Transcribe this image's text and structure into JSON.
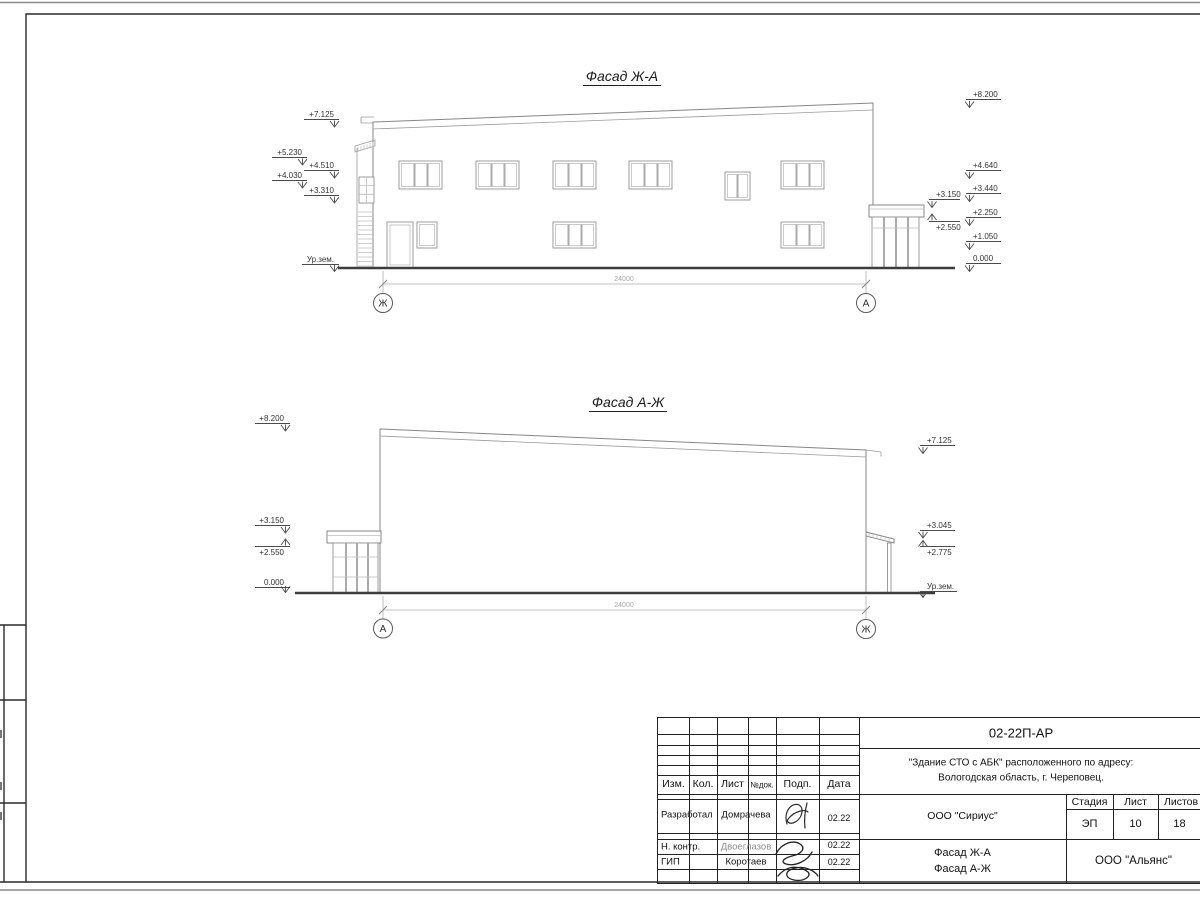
{
  "sheet": {
    "facade_top": {
      "title": "Фасад Ж-А",
      "axis_left": "Ж",
      "axis_right": "А",
      "dimension": "24000",
      "marks_left": [
        "+7.125",
        "+5.230",
        "+4.510",
        "+4.030",
        "+3.310",
        "Ур.зем."
      ],
      "marks_right": [
        "+8.200",
        "+4.640",
        "+3.440",
        "+2.250",
        "+1.050",
        "0.000"
      ],
      "marks_porch": [
        "+3.150",
        "+2.550"
      ]
    },
    "facade_bottom": {
      "title": "Фасад А-Ж",
      "axis_left": "А",
      "axis_right": "Ж",
      "dimension": "24000",
      "marks_left": [
        "+8.200",
        "+3.150",
        "+2.550",
        "0.000"
      ],
      "marks_right": [
        "+7.125",
        "+3.045",
        "+2.775",
        "Ур.зем."
      ]
    }
  },
  "titleblock": {
    "doc_number": "02-22П-АР",
    "project_address_line1": "\"Здание СТО с АБК\" расположенного по адресу:",
    "project_address_line2": "Вологодская область, г. Череповец.",
    "columns": {
      "izm": "Изм.",
      "kol": "Кол.",
      "list": "Лист",
      "doc": "№док.",
      "sign": "Подп.",
      "date": "Дата"
    },
    "rows": [
      {
        "role": "Разработал",
        "name": "Домрачева",
        "date": "02.22"
      },
      {
        "role": "Н. контр.",
        "name": "Двоеглазов",
        "date": "02.22"
      },
      {
        "role": "ГИП",
        "name": "Коротаев",
        "date": "02.22"
      }
    ],
    "designer_org": "ООО \"Сириус\"",
    "drawing_title_line1": "Фасад Ж-А",
    "drawing_title_line2": "Фасад А-Ж",
    "stage_label": "Стадия",
    "sheet_label": "Лист",
    "sheets_label": "Листов",
    "stage": "ЭП",
    "sheet_number": "10",
    "sheets_total": "18",
    "contractor_org": "ООО \"Альянс\""
  }
}
